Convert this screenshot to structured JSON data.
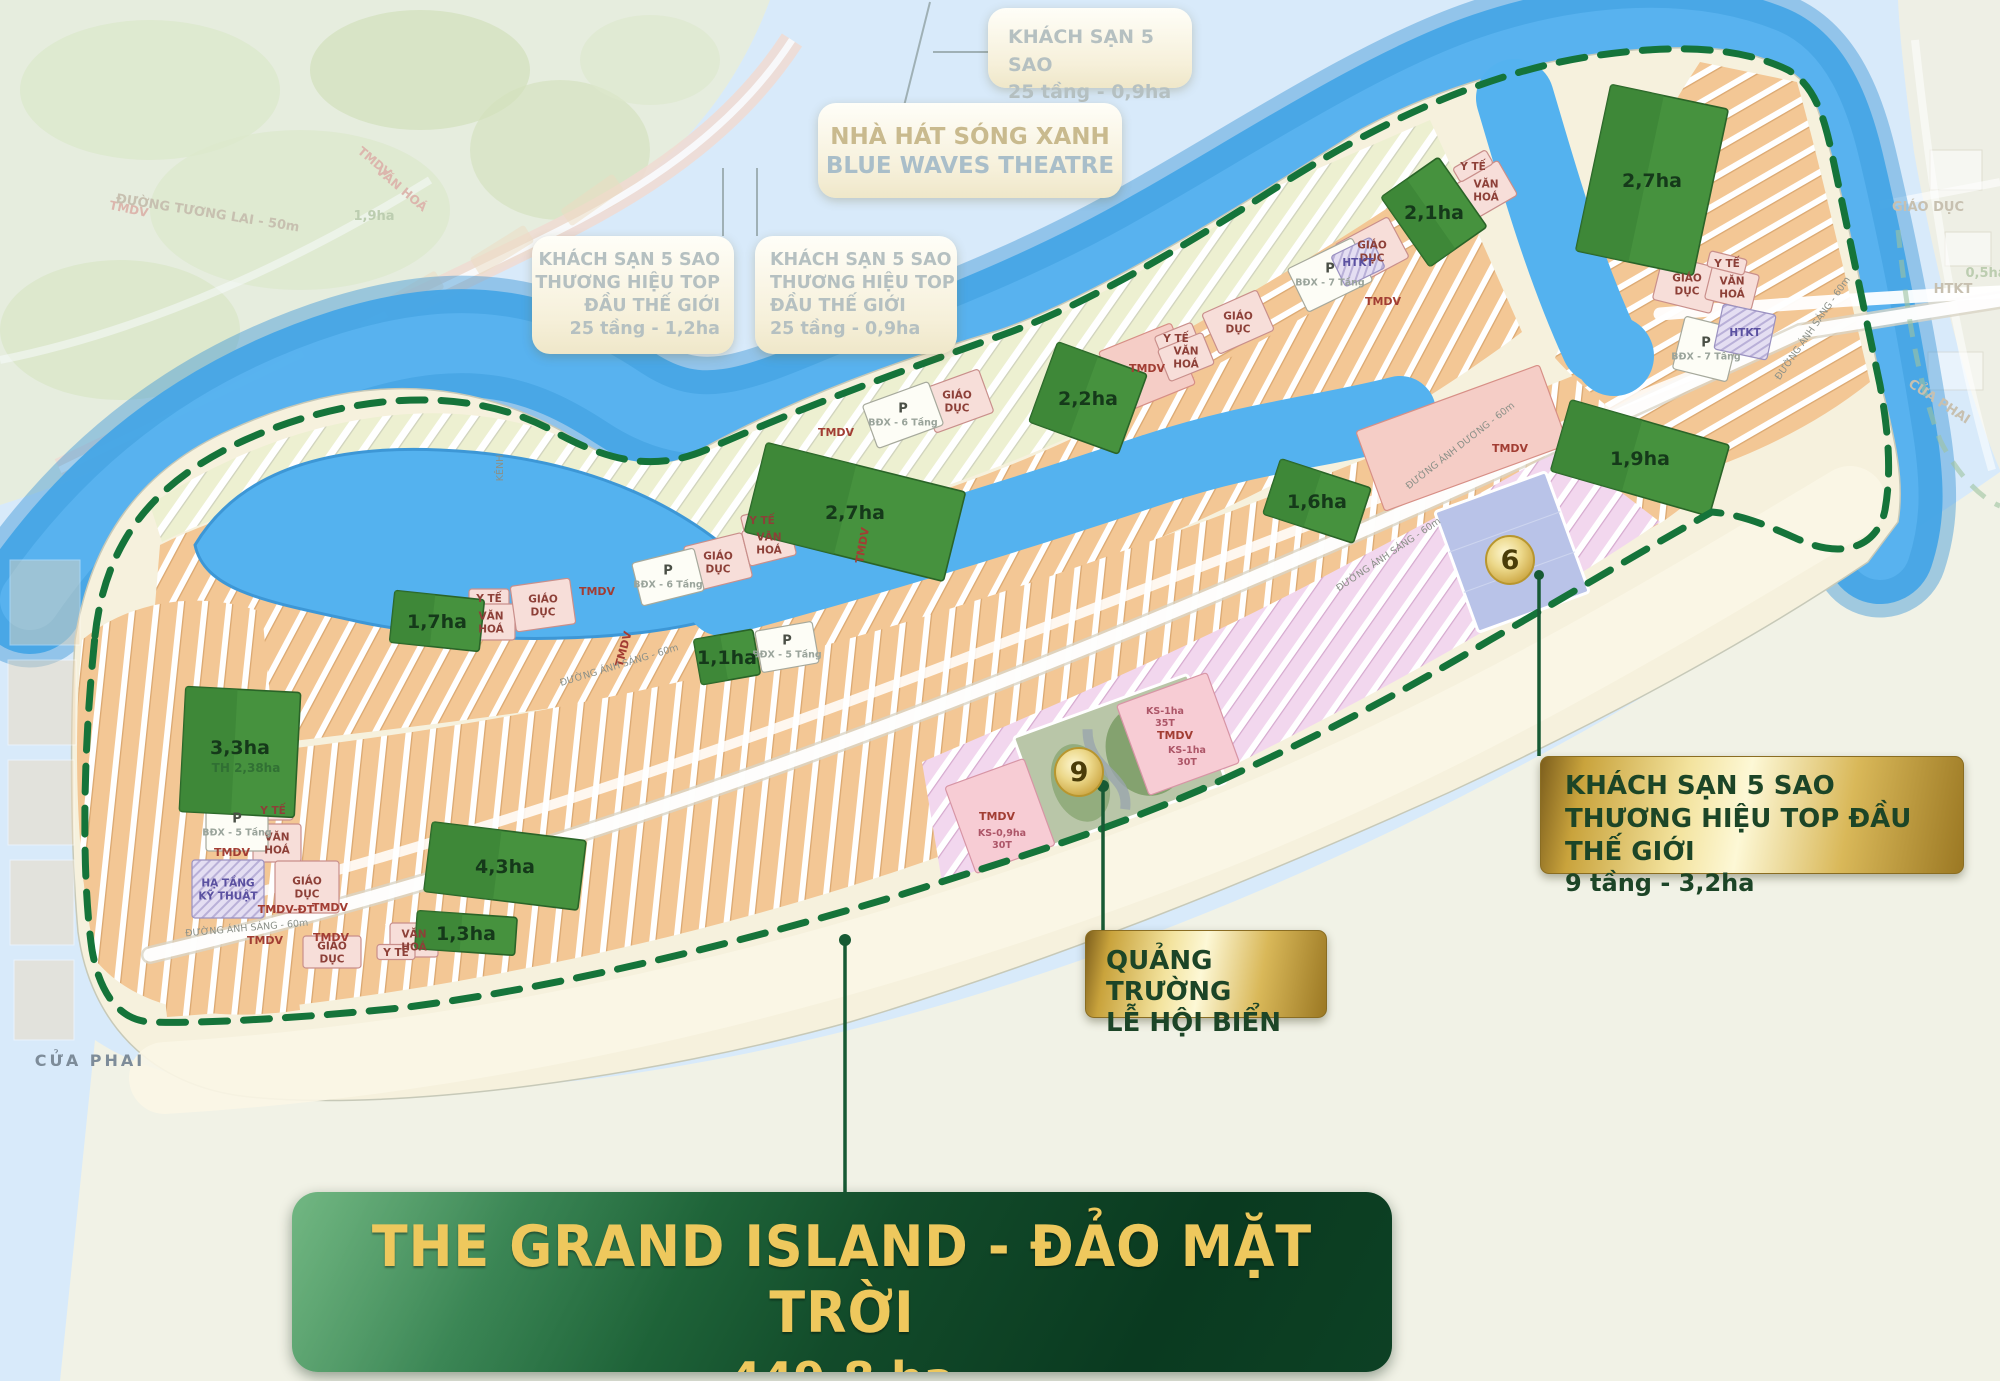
{
  "callouts": {
    "top_hotel": {
      "line1": "KHÁCH SẠN 5 SAO",
      "line2": "25 tầng - 0,9ha"
    },
    "theatre": {
      "line1": "NHÀ HÁT SÓNG XANH",
      "line2": "BLUE WAVES THEATRE"
    },
    "left_hotel": {
      "line1": "KHÁCH SẠN 5 SAO",
      "line2": "THƯƠNG HIỆU TOP",
      "line3": "ĐẦU THẾ GIỚI",
      "line4": "25 tầng - 1,2ha"
    },
    "center_hotel": {
      "line1": "KHÁCH SẠN 5 SAO",
      "line2": "THƯƠNG HIỆU TOP",
      "line3": "ĐẦU THẾ GIỚI",
      "line4": "25 tầng - 0,9ha"
    },
    "right_hotel": {
      "line1": "KHÁCH SẠN 5 SAO",
      "line2": "THƯƠNG HIỆU TOP ĐẦU THẾ GIỚI",
      "line3": "9 tầng - 3,2ha"
    },
    "square": {
      "line1": "QUẢNG TRƯỜNG",
      "line2": "LỄ HỘI BIỂN"
    },
    "main": {
      "title": "THE GRAND ISLAND - ĐẢO MẶT TRỜI",
      "area": "449,8 ha"
    }
  },
  "palette": {
    "water": "#54b2ef",
    "river": "#46a5e6",
    "river_deep": "#3d97d6",
    "pale_water": "#d8eafa",
    "sand": "#f6f1dd",
    "beach": "#faf5e8",
    "park": "#46923e",
    "park_dark": "#2a6428",
    "boundary_green": "#15743a",
    "gold": "#d9b859",
    "leader_green": "#175a34"
  },
  "map": {
    "markers": [
      {
        "n": "6",
        "x": 1510,
        "y": 560
      },
      {
        "n": "9",
        "x": 1079,
        "y": 772
      }
    ],
    "parks": [
      {
        "label": "2,1ha",
        "x": 1434,
        "y": 212,
        "w": 70,
        "h": 85,
        "rot": -35
      },
      {
        "label": "2,7ha",
        "x": 1652,
        "y": 180,
        "w": 120,
        "h": 170,
        "rot": 12
      },
      {
        "label": "2,2ha",
        "x": 1088,
        "y": 398,
        "w": 95,
        "h": 85,
        "rot": 20
      },
      {
        "label": "2,7ha",
        "x": 855,
        "y": 512,
        "w": 205,
        "h": 92,
        "rot": 14
      },
      {
        "label": "1,6ha",
        "x": 1317,
        "y": 501,
        "w": 95,
        "h": 58,
        "rot": 18
      },
      {
        "label": "1,9ha",
        "x": 1640,
        "y": 458,
        "w": 165,
        "h": 74,
        "rot": 16
      },
      {
        "label": "1,7ha",
        "x": 437,
        "y": 621,
        "w": 90,
        "h": 52,
        "rot": 6
      },
      {
        "label": "3,3ha",
        "sub": "TH 2,38ha",
        "x": 240,
        "y": 752,
        "w": 115,
        "h": 125,
        "rot": 3
      },
      {
        "label": "4,3ha",
        "x": 505,
        "y": 866,
        "w": 155,
        "h": 70,
        "rot": 7
      },
      {
        "label": "1,3ha",
        "x": 466,
        "y": 933,
        "w": 100,
        "h": 38,
        "rot": 4
      },
      {
        "label": "1,1ha",
        "x": 727,
        "y": 657,
        "w": 60,
        "h": 46,
        "rot": -10
      }
    ],
    "blocks": [
      {
        "type": "pink",
        "x": 273,
        "y": 810,
        "w": 40,
        "h": 20,
        "rot": 0,
        "lines": [
          "Y TẾ"
        ]
      },
      {
        "type": "pink",
        "x": 277,
        "y": 843,
        "w": 48,
        "h": 38,
        "rot": 0,
        "lines": [
          "VĂN",
          "HOÁ"
        ]
      },
      {
        "type": "pink",
        "x": 307,
        "y": 887,
        "w": 64,
        "h": 52,
        "rot": 0,
        "lines": [
          "GIÁO",
          "DỤC"
        ]
      },
      {
        "type": "pink",
        "x": 489,
        "y": 598,
        "w": 40,
        "h": 18,
        "rot": 0,
        "lines": [
          "Y TẾ"
        ]
      },
      {
        "type": "pink",
        "x": 491,
        "y": 622,
        "w": 48,
        "h": 36,
        "rot": 0,
        "lines": [
          "VĂN",
          "HOÁ"
        ]
      },
      {
        "type": "pink",
        "x": 543,
        "y": 605,
        "w": 60,
        "h": 46,
        "rot": -8,
        "lines": [
          "GIÁO",
          "DỤC"
        ]
      },
      {
        "type": "pink",
        "x": 718,
        "y": 562,
        "w": 60,
        "h": 46,
        "rot": -14,
        "lines": [
          "GIÁO",
          "DỤC"
        ]
      },
      {
        "type": "pink",
        "x": 762,
        "y": 520,
        "w": 40,
        "h": 18,
        "rot": -14,
        "lines": [
          "Y TẾ"
        ]
      },
      {
        "type": "pink",
        "x": 769,
        "y": 543,
        "w": 48,
        "h": 36,
        "rot": -14,
        "lines": [
          "VĂN",
          "HOÁ"
        ]
      },
      {
        "type": "pink",
        "x": 957,
        "y": 401,
        "w": 62,
        "h": 46,
        "rot": -20,
        "lines": [
          "GIÁO",
          "DỤC"
        ]
      },
      {
        "type": "pinkzone",
        "x": 1147,
        "y": 368,
        "w": 78,
        "h": 66,
        "rot": -22,
        "lines": [
          "TMDV"
        ]
      },
      {
        "type": "pink",
        "x": 1176,
        "y": 338,
        "w": 40,
        "h": 18,
        "rot": -22,
        "lines": [
          "Y TẾ"
        ]
      },
      {
        "type": "pink",
        "x": 1186,
        "y": 357,
        "w": 48,
        "h": 34,
        "rot": -22,
        "lines": [
          "VĂN",
          "HOÁ"
        ]
      },
      {
        "type": "pink",
        "x": 1238,
        "y": 322,
        "w": 60,
        "h": 44,
        "rot": -24,
        "lines": [
          "GIÁO",
          "DỤC"
        ]
      },
      {
        "type": "pink",
        "x": 1372,
        "y": 251,
        "w": 60,
        "h": 46,
        "rot": -28,
        "lines": [
          "GIÁO",
          "DỤC"
        ]
      },
      {
        "type": "pink",
        "x": 1486,
        "y": 190,
        "w": 50,
        "h": 40,
        "rot": -30,
        "lines": [
          "VĂN",
          "HOÁ"
        ]
      },
      {
        "type": "pink",
        "x": 1473,
        "y": 166,
        "w": 38,
        "h": 16,
        "rot": -30,
        "lines": [
          "Y TẾ"
        ]
      },
      {
        "type": "pink",
        "x": 1687,
        "y": 284,
        "w": 60,
        "h": 46,
        "rot": 14,
        "lines": [
          "GIÁO",
          "DỤC"
        ]
      },
      {
        "type": "pink",
        "x": 1732,
        "y": 287,
        "w": 48,
        "h": 36,
        "rot": 14,
        "lines": [
          "VĂN",
          "HOÁ"
        ]
      },
      {
        "type": "pink",
        "x": 1727,
        "y": 263,
        "w": 38,
        "h": 16,
        "rot": 14,
        "lines": [
          "Y TẾ"
        ]
      },
      {
        "type": "pink",
        "x": 414,
        "y": 940,
        "w": 48,
        "h": 34,
        "rot": 0,
        "lines": [
          "VĂN",
          "HOÁ"
        ]
      },
      {
        "type": "pink",
        "x": 396,
        "y": 952,
        "w": 38,
        "h": 15,
        "rot": 0,
        "lines": [
          "Y TẾ"
        ]
      },
      {
        "type": "pink",
        "x": 332,
        "y": 952,
        "w": 58,
        "h": 32,
        "rot": 0,
        "lines": [
          "GIÁO",
          "DỤC"
        ]
      },
      {
        "type": "pinkzone",
        "x": 1462,
        "y": 438,
        "w": 195,
        "h": 85,
        "rot": -20,
        "lines": []
      },
      {
        "type": "white",
        "x": 237,
        "y": 825,
        "w": 62,
        "h": 52,
        "rot": 0,
        "lines": [
          "P",
          "BĐX - 5 Tầng"
        ]
      },
      {
        "type": "white",
        "x": 668,
        "y": 577,
        "w": 64,
        "h": 44,
        "rot": -14,
        "lines": [
          "P",
          "BĐX - 6 Tầng"
        ]
      },
      {
        "type": "white",
        "x": 903,
        "y": 415,
        "w": 70,
        "h": 46,
        "rot": -20,
        "lines": [
          "P",
          "BĐX - 6 Tầng"
        ]
      },
      {
        "type": "white",
        "x": 1330,
        "y": 275,
        "w": 72,
        "h": 48,
        "rot": -26,
        "lines": [
          "P",
          "BĐX - 7 Tầng"
        ]
      },
      {
        "type": "white",
        "x": 1706,
        "y": 349,
        "w": 56,
        "h": 54,
        "rot": 14,
        "lines": [
          "P",
          "BĐX - 7 Tầng"
        ]
      },
      {
        "type": "white",
        "x": 787,
        "y": 647,
        "w": 58,
        "h": 42,
        "rot": -10,
        "lines": [
          "P",
          "BĐX - 5 Tầng"
        ]
      },
      {
        "type": "purple",
        "x": 228,
        "y": 889,
        "w": 72,
        "h": 58,
        "rot": 0,
        "lines": [
          "HẠ TẦNG",
          "KỸ THUẬT"
        ]
      },
      {
        "type": "purple",
        "x": 1745,
        "y": 332,
        "w": 54,
        "h": 46,
        "rot": 12,
        "lines": [
          "HTKT"
        ]
      },
      {
        "type": "purple",
        "x": 1358,
        "y": 262,
        "w": 44,
        "h": 34,
        "rot": -26,
        "lines": [
          "HTKT"
        ]
      },
      {
        "type": "lav",
        "x": 1512,
        "y": 552,
        "w": 118,
        "h": 128,
        "rot": -20,
        "lines": []
      },
      {
        "type": "fest",
        "x": 1120,
        "y": 760,
        "w": 185,
        "h": 115,
        "rot": -20,
        "lines": []
      },
      {
        "type": "kspink",
        "x": 1000,
        "y": 816,
        "w": 84,
        "h": 92,
        "rot": -20,
        "lines": []
      },
      {
        "type": "kspink",
        "x": 1178,
        "y": 734,
        "w": 96,
        "h": 96,
        "rot": -20,
        "lines": []
      }
    ],
    "labels": [
      {
        "t": "TMDV",
        "x": 232,
        "y": 856,
        "cls": "tmdv"
      },
      {
        "t": "TMDV",
        "x": 265,
        "y": 944,
        "cls": "tmdv"
      },
      {
        "t": "TMDV-ĐT",
        "x": 286,
        "y": 913,
        "cls": "tmdv"
      },
      {
        "t": "TMDV",
        "x": 330,
        "y": 911,
        "cls": "tmdv"
      },
      {
        "t": "TMDV",
        "x": 331,
        "y": 941,
        "cls": "tmdv"
      },
      {
        "t": "TMDV",
        "x": 597,
        "y": 595,
        "cls": "tmdv"
      },
      {
        "t": "TMDV",
        "x": 627,
        "y": 650,
        "cls": "tmdv",
        "rot": -75
      },
      {
        "t": "TMDV",
        "x": 836,
        "y": 436,
        "cls": "tmdv"
      },
      {
        "t": "TMDV",
        "x": 866,
        "y": 546,
        "cls": "tmdv",
        "rot": -80
      },
      {
        "t": "TMDV",
        "x": 1175,
        "y": 739,
        "cls": "tmdv"
      },
      {
        "t": "TMDV",
        "x": 997,
        "y": 820,
        "cls": "tmdv"
      },
      {
        "t": "TMDV",
        "x": 1383,
        "y": 305,
        "cls": "tmdv"
      },
      {
        "t": "TMDV",
        "x": 1510,
        "y": 452,
        "cls": "tmdv"
      },
      {
        "t": "KS-1ha",
        "x": 1165,
        "y": 714,
        "cls": "ks"
      },
      {
        "t": "35T",
        "x": 1165,
        "y": 726,
        "cls": "ks"
      },
      {
        "t": "KS-1ha",
        "x": 1187,
        "y": 753,
        "cls": "ks"
      },
      {
        "t": "30T",
        "x": 1187,
        "y": 765,
        "cls": "ks"
      },
      {
        "t": "KS-0,9ha",
        "x": 1002,
        "y": 836,
        "cls": "ks"
      },
      {
        "t": "30T",
        "x": 1002,
        "y": 848,
        "cls": "ks"
      },
      {
        "t": "KÊNH",
        "x": 503,
        "y": 468,
        "cls": "road",
        "rot": -90
      }
    ],
    "roads": [
      {
        "t": "ĐƯỜNG ÁNH SÁNG - 60m",
        "x": 247,
        "y": 931,
        "rot": -5
      },
      {
        "t": "ĐƯỜNG ÁNH SÁNG - 60m",
        "x": 620,
        "y": 668,
        "rot": -17
      },
      {
        "t": "ĐƯỜNG ÁNH SÁNG - 60m",
        "x": 1390,
        "y": 557,
        "rot": -34
      },
      {
        "t": "ĐƯỜNG ÁNH SÁNG - 60m",
        "x": 1815,
        "y": 330,
        "rot": -55
      },
      {
        "t": "ĐƯỜNG ÁNH DƯƠNG - 60m",
        "x": 1462,
        "y": 448,
        "rot": -38
      }
    ],
    "ghosts": [
      {
        "t": "TMDV",
        "x": 128,
        "y": 213,
        "cls": "ghostpink",
        "rot": 12
      },
      {
        "t": "ĐƯỜNG TƯƠNG LAI - 50m",
        "x": 207,
        "y": 217,
        "cls": "ghost",
        "rot": 9
      },
      {
        "t": "TMDV",
        "x": 372,
        "y": 165,
        "cls": "ghostpink",
        "rot": 40
      },
      {
        "t": "VĂN HOÁ",
        "x": 399,
        "y": 192,
        "cls": "ghostpink",
        "rot": 40
      },
      {
        "t": "1,9ha",
        "x": 374,
        "y": 220,
        "cls": "ghostgreen"
      },
      {
        "t": "GIÁO DỤC",
        "x": 1928,
        "y": 211,
        "cls": "ghost"
      },
      {
        "t": "HTKT",
        "x": 1953,
        "y": 293,
        "cls": "ghost"
      },
      {
        "t": "0,5ha",
        "x": 1986,
        "y": 277,
        "cls": "ghostgreen"
      },
      {
        "t": "CỬA PHAI",
        "x": 1937,
        "y": 405,
        "cls": "ghost",
        "rot": 33
      },
      {
        "t": "CỬA PHAI",
        "x": 90,
        "y": 1066,
        "cls": "shore"
      }
    ]
  }
}
